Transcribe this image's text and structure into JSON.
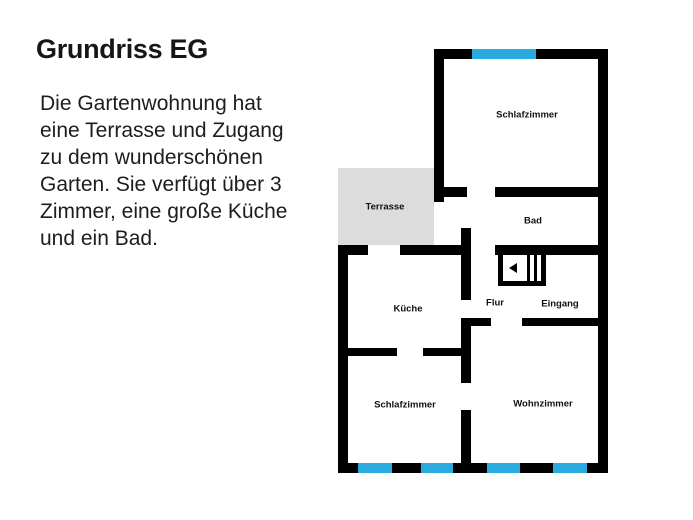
{
  "header": {
    "title": "Grundriss EG"
  },
  "description": {
    "lines": [
      "Die Gartenwohnung hat",
      "eine Terrasse und Zugang",
      "zu dem wunderschönen",
      "Garten. Sie verfügt über 3",
      "Zimmer, eine große Küche",
      "und ein Bad."
    ]
  },
  "plan": {
    "colors": {
      "wall": "#000000",
      "window": "#29abe2",
      "terrace": "#dcdcdc"
    },
    "rooms": [
      {
        "id": "schlafzimmer-top",
        "label": "Schlafzimmer"
      },
      {
        "id": "bad",
        "label": "Bad"
      },
      {
        "id": "terrasse",
        "label": "Terrasse"
      },
      {
        "id": "kueche",
        "label": "Küche"
      },
      {
        "id": "flur",
        "label": "Flur"
      },
      {
        "id": "eingang",
        "label": "Eingang"
      },
      {
        "id": "schlafzimmer-bottom",
        "label": "Schlafzimmer"
      },
      {
        "id": "wohnzimmer",
        "label": "Wohnzimmer"
      }
    ]
  }
}
